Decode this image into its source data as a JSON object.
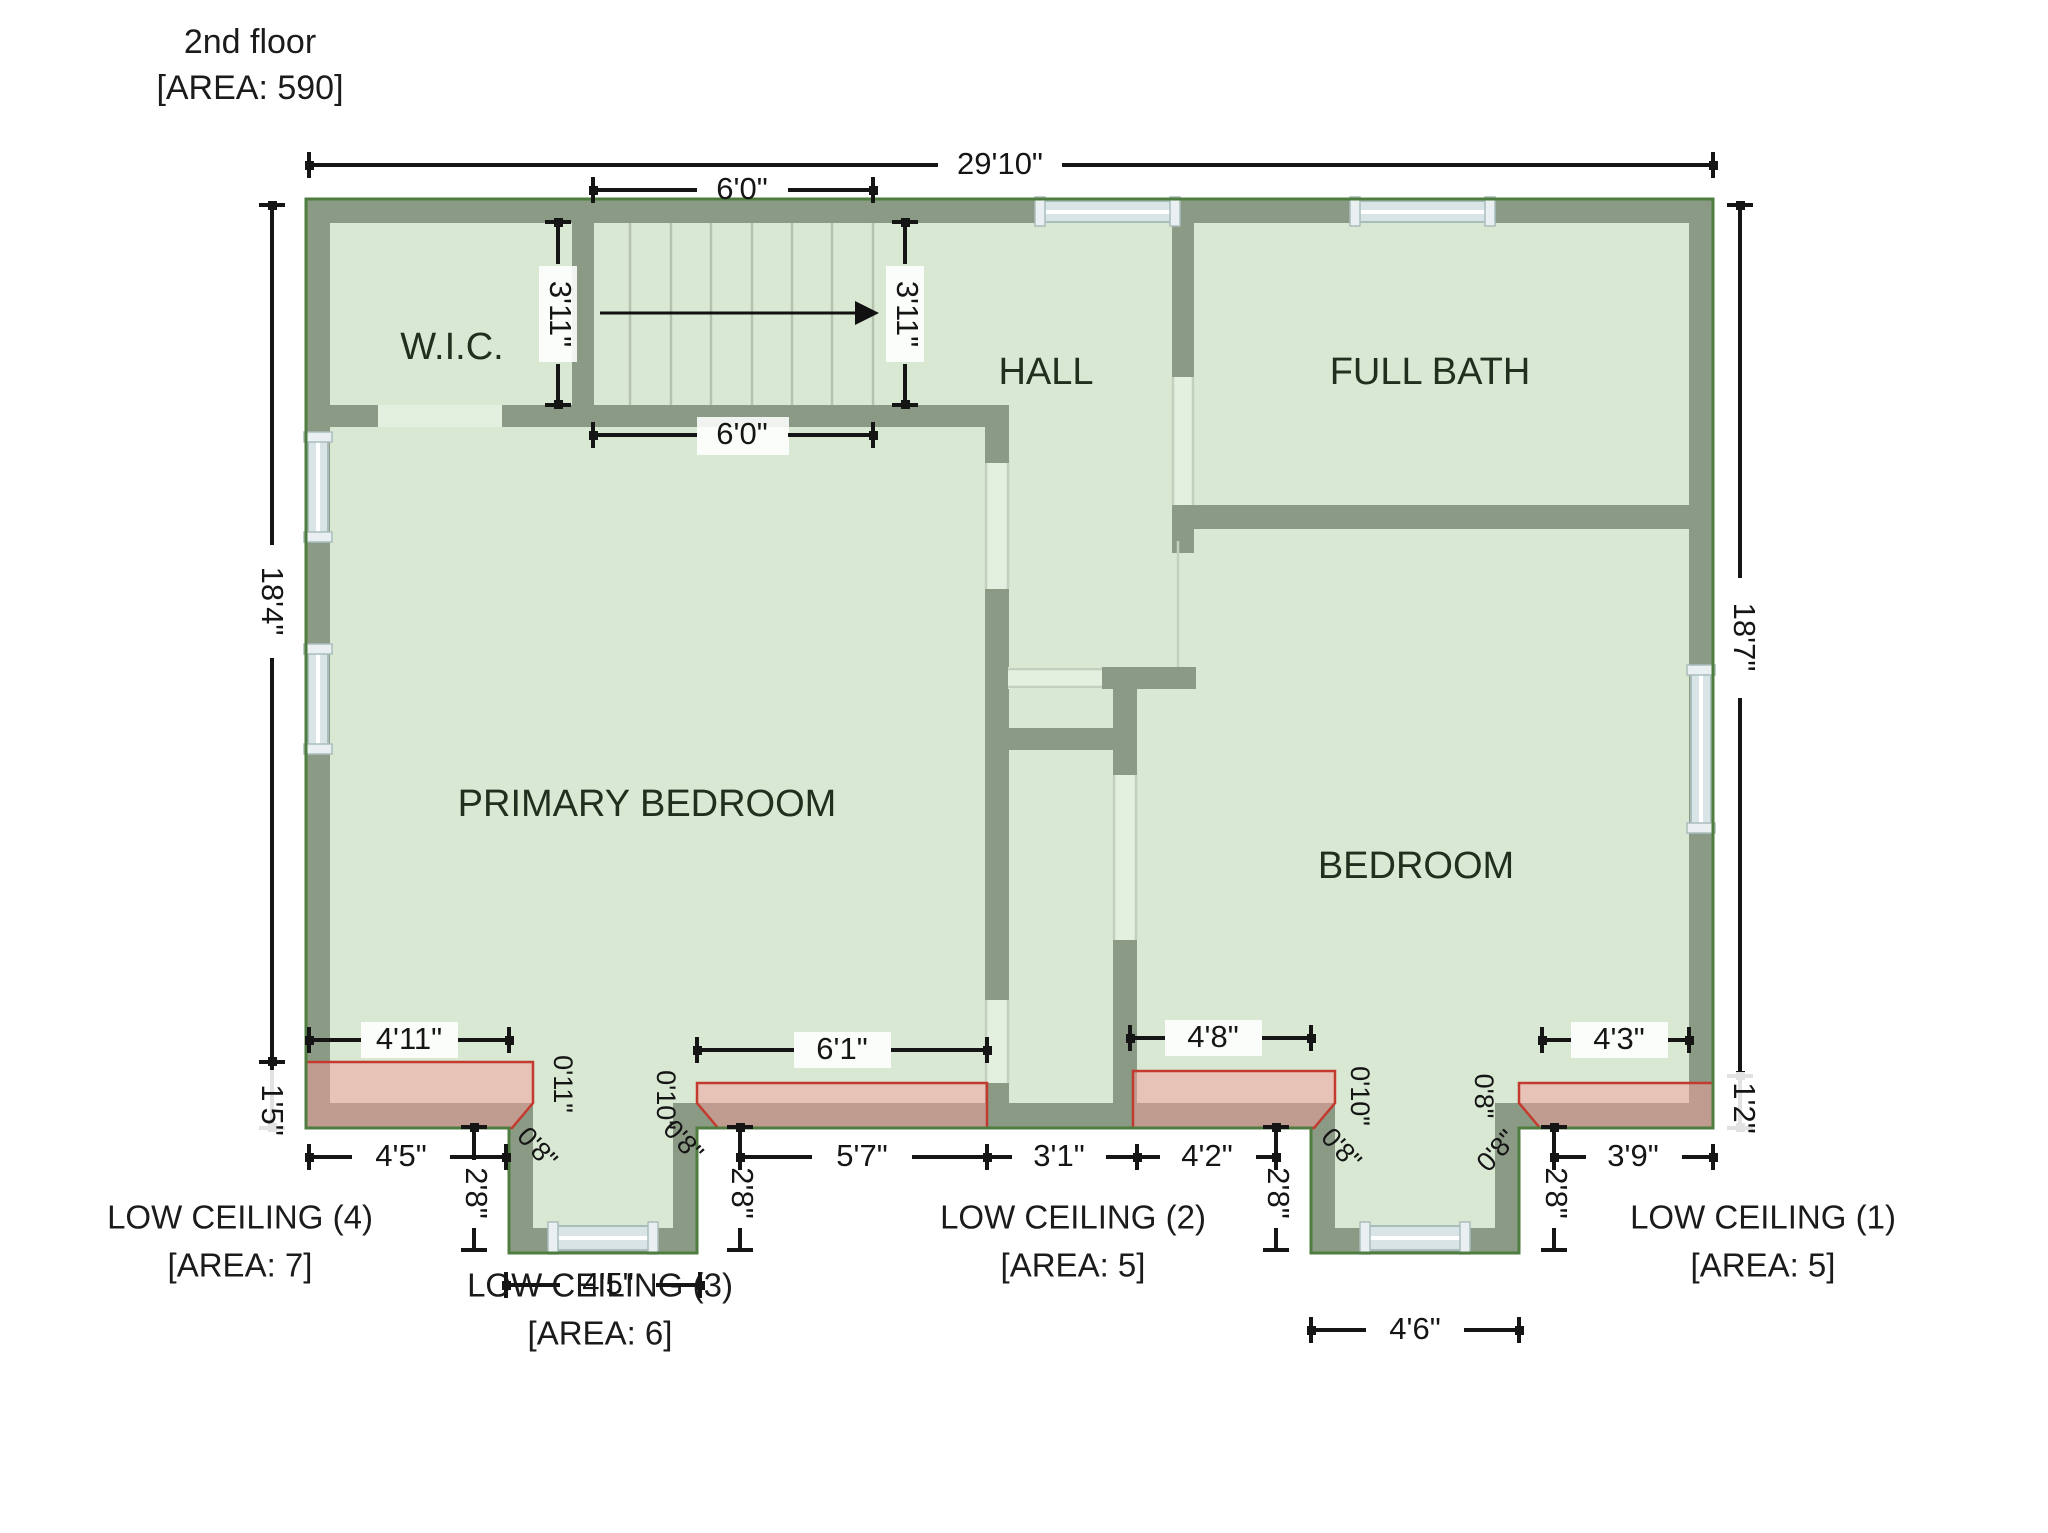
{
  "title": {
    "line1": "2nd floor",
    "line2": "[AREA: 590]"
  },
  "rooms": {
    "wic": "W.I.C.",
    "hall": "HALL",
    "full_bath": "FULL BATH",
    "primary_bedroom": "PRIMARY BEDROOM",
    "bedroom": "BEDROOM"
  },
  "dims": {
    "total_width": "29'10\"",
    "stair_top": "6'0\"",
    "stair_bottom": "6'0\"",
    "stair_left": "3'11\"",
    "stair_right": "3'11\"",
    "left_main": "18'4\"",
    "left_low": "1'5\"",
    "right_main": "18'7\"",
    "right_low": "1'2\"",
    "strip4": "4'11\"",
    "strip3": "6'1\"",
    "strip2": "4'8\"",
    "strip1": "4'3\"",
    "row1": "4'5\"",
    "row2": "5'7\"",
    "row3": "3'1\"",
    "row4": "4'2\"",
    "row5": "3'9\"",
    "riser1": "2'8\"",
    "riser2": "2'8\"",
    "riser3": "2'8\"",
    "riser4": "2'8\"",
    "bump1_width": "4'5\"",
    "bump2_width": "4'6\"",
    "corner_b1l_a": "0'11\"",
    "corner_b1l_b": "0'8\"",
    "corner_b1r_a": "0'10\"",
    "corner_b1r_b": "0'8\"",
    "corner_b2l_a": "0'10\"",
    "corner_b2l_b": "0'8\"",
    "corner_b2r_a": "0'8\"",
    "corner_b2r_b": "0'8\""
  },
  "low_ceilings": [
    {
      "name": "LOW CEILING (4)",
      "area": "[AREA: 7]"
    },
    {
      "name": "LOW CEILING (3)",
      "area": "[AREA: 6]"
    },
    {
      "name": "LOW CEILING (2)",
      "area": "[AREA: 5]"
    },
    {
      "name": "LOW CEILING (1)",
      "area": "[AREA: 5]"
    }
  ],
  "colors": {
    "wall": "#8b9a85",
    "floor": "#d8e8d3",
    "floorLight": "#e3efdf",
    "outline": "#4e7d3f",
    "window": "#d9e4e6",
    "windowCap": "#eaf0f1",
    "windowFrame": "#a9bdbd",
    "tread": "#b5c2ae",
    "divider": "#c3d0bd",
    "pink": "#f59b9b",
    "pinkBorder": "#c23b2e",
    "dim": "#151515",
    "roomLabel": "#20301f",
    "text": "#1b1b1b"
  }
}
